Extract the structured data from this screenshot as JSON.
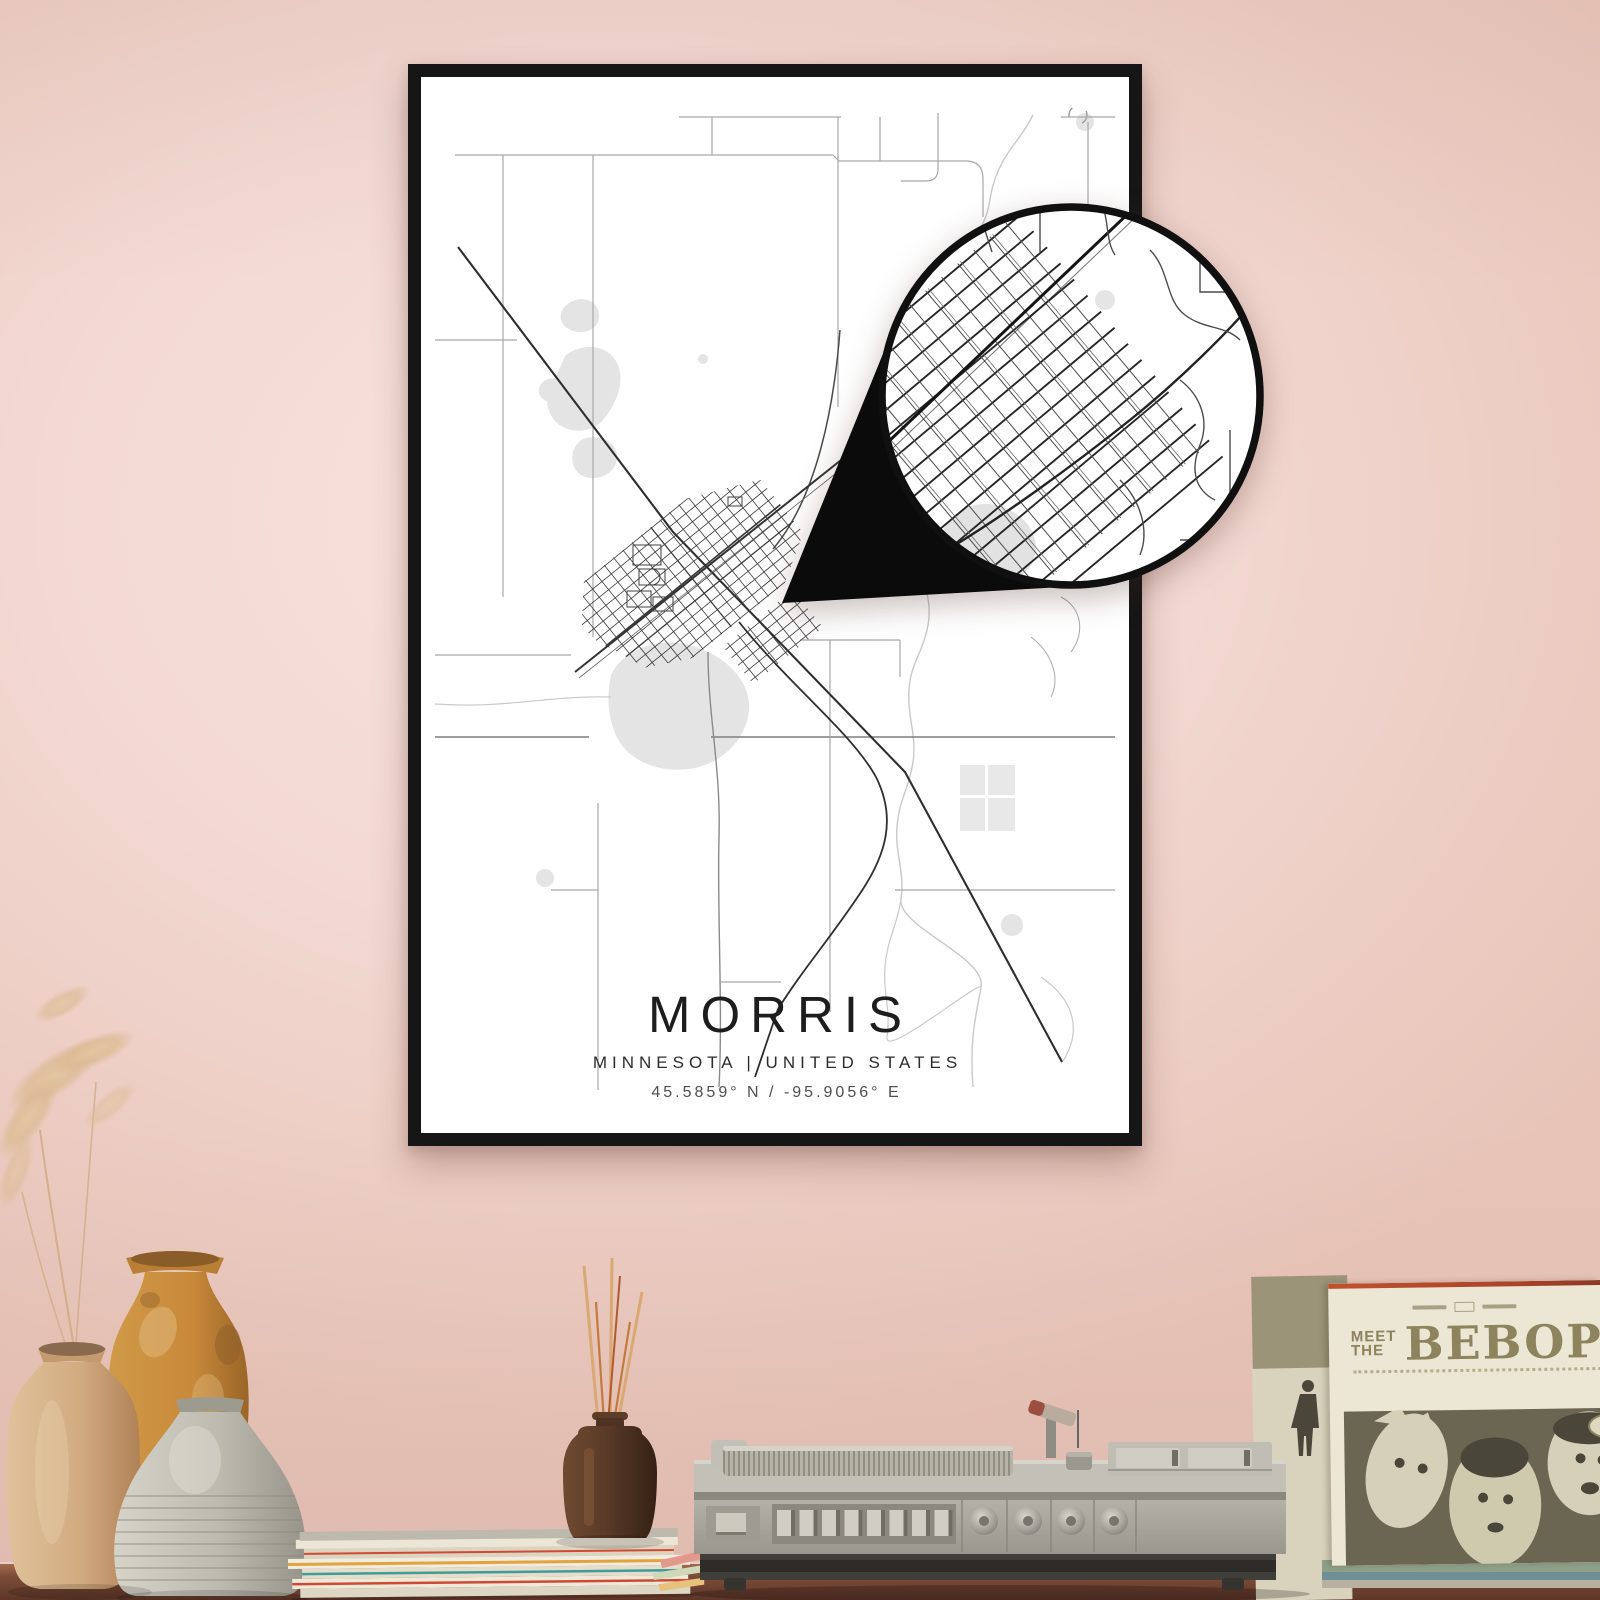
{
  "poster": {
    "title": "MORRIS",
    "subtitle": "MINNESOTA | UNITED STATES",
    "coordinates": "45.5859° N / -95.9056° E"
  },
  "record_sleeve": {
    "meet": "MEET",
    "the": "THE",
    "title": "BEBOP"
  },
  "colors": {
    "wall_pink": "#f3d9d2",
    "wall_edge": "#e8c4b8",
    "frame_black": "#161616",
    "poster_white": "#ffffff",
    "road_dark": "#2e2e2e",
    "road_light": "#a8a8a8",
    "water_gray": "#e4e4e4",
    "river_gray": "#c9c9c9",
    "magnifier_ring": "#101010",
    "wood_brown": "#7c4b38",
    "player_gray": "#b5b3a9",
    "sleeve_cream": "#ece7d4",
    "sleeve_olive_text": "#8d835c",
    "sleeve_photo_olive": "#6b6652",
    "sleeve_accent_red": "#c2502e",
    "vase_tan": "#cfa87e",
    "vase_orange": "#c8893a",
    "vase_gray": "#bdbab0",
    "diffuser_brown": "#5a3b28",
    "pampas_beige": "#dcb992"
  }
}
